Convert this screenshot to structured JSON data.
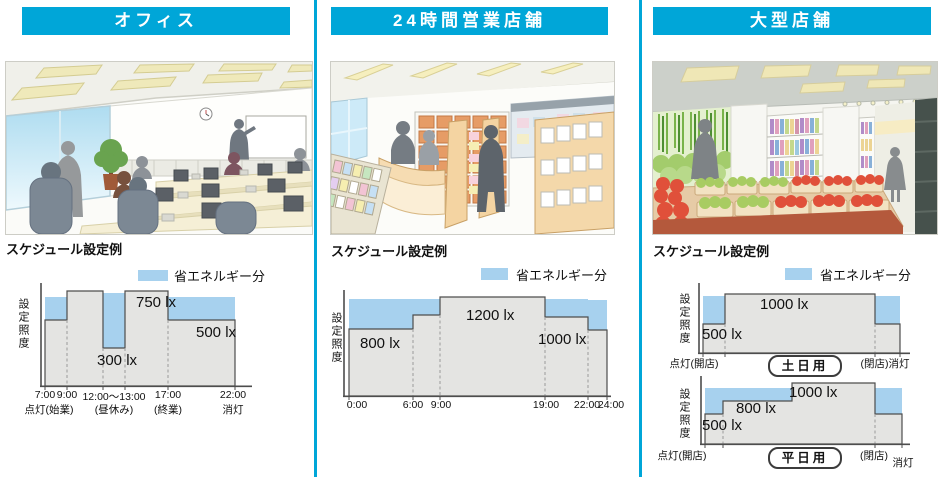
{
  "panels": [
    {
      "title": "オフィス",
      "caption": "スケジュール設定例",
      "legend_label": "省エネルギー分",
      "chart": {
        "ylabel": "設定照度",
        "labels": {
          "l750": "750 lx",
          "l300": "300 lx",
          "l500": "500 lx"
        },
        "ticks": [
          "7:00",
          "9:00",
          "12:00〜13:00",
          "17:00",
          "22:00"
        ],
        "tick_notes": [
          "点灯(始業)",
          "(昼休み)",
          "(終業)",
          "消灯"
        ]
      }
    },
    {
      "title": "24時間営業店舗",
      "caption": "スケジュール設定例",
      "legend_label": "省エネルギー分",
      "chart": {
        "ylabel": "設定照度",
        "labels": {
          "l800": "800 lx",
          "l1200": "1200 lx",
          "l1000": "1000 lx"
        },
        "ticks": [
          "0:00",
          "6:00",
          "9:00",
          "19:00",
          "22:00",
          "24:00"
        ]
      }
    },
    {
      "title": "大型店舗",
      "caption": "スケジュール設定例",
      "legend_label": "省エネルギー分",
      "chart_weekend": {
        "ylabel": "設定照度",
        "labels": {
          "l1000": "1000 lx",
          "l500": "500 lx"
        },
        "tick_left": "点灯(開店)",
        "tick_right": "(閉店)消灯",
        "badge": "土日用"
      },
      "chart_weekday": {
        "ylabel": "設定照度",
        "labels": {
          "l1000": "1000 lx",
          "l800": "800 lx",
          "l500": "500 lx"
        },
        "tick_left": "点灯(開店)",
        "tick_right_close": "(閉店)",
        "tick_right_off": "消灯",
        "badge": "平日用"
      }
    }
  ],
  "colors": {
    "accent_cyan": "#00a6d8",
    "saving_blue": "#a7d1ee",
    "fill_gray": "#e4e4e2",
    "outline": "#4d4d4d"
  },
  "chart_data": [
    {
      "type": "area",
      "title": "オフィス スケジュール設定例",
      "ylabel": "設定照度",
      "unit": "lx",
      "legend": "省エネルギー分",
      "segments": [
        {
          "from": "7:00",
          "to": "9:00",
          "set_lx": 500
        },
        {
          "from": "9:00",
          "to": "12:00",
          "set_lx": 750
        },
        {
          "from": "12:00",
          "to": "13:00",
          "set_lx": 300,
          "note": "昼休み"
        },
        {
          "from": "13:00",
          "to": "17:00",
          "set_lx": 750
        },
        {
          "from": "17:00",
          "to": "22:00",
          "set_lx": 500
        }
      ],
      "events": {
        "7:00": "点灯(始業)",
        "22:00": "消灯"
      }
    },
    {
      "type": "area",
      "title": "24時間営業店舗 スケジュール設定例",
      "ylabel": "設定照度",
      "unit": "lx",
      "legend": "省エネルギー分",
      "segments": [
        {
          "from": "0:00",
          "to": "6:00",
          "set_lx": 800
        },
        {
          "from": "6:00",
          "to": "9:00",
          "set_lx": 1000
        },
        {
          "from": "9:00",
          "to": "19:00",
          "set_lx": 1200
        },
        {
          "from": "19:00",
          "to": "22:00",
          "set_lx": 1000
        },
        {
          "from": "22:00",
          "to": "24:00",
          "set_lx": 800
        }
      ]
    },
    {
      "type": "area",
      "title": "大型店舗 スケジュール設定例 (土日用)",
      "ylabel": "設定照度",
      "unit": "lx",
      "legend": "省エネルギー分",
      "segments": [
        {
          "from": "点灯(開店)",
          "to": "step",
          "set_lx": 500
        },
        {
          "from": "step",
          "to": "閉店前",
          "set_lx": 1000
        },
        {
          "from": "閉店前",
          "to": "(閉店)消灯",
          "set_lx": 500
        }
      ]
    },
    {
      "type": "area",
      "title": "大型店舗 スケジュール設定例 (平日用)",
      "ylabel": "設定照度",
      "unit": "lx",
      "legend": "省エネルギー分",
      "segments": [
        {
          "from": "点灯(開店)",
          "to": "step1",
          "set_lx": 500
        },
        {
          "from": "step1",
          "to": "step2",
          "set_lx": 800
        },
        {
          "from": "step2",
          "to": "閉店前",
          "set_lx": 1000
        },
        {
          "from": "閉店前",
          "to": "消灯",
          "set_lx": 500
        }
      ]
    }
  ]
}
